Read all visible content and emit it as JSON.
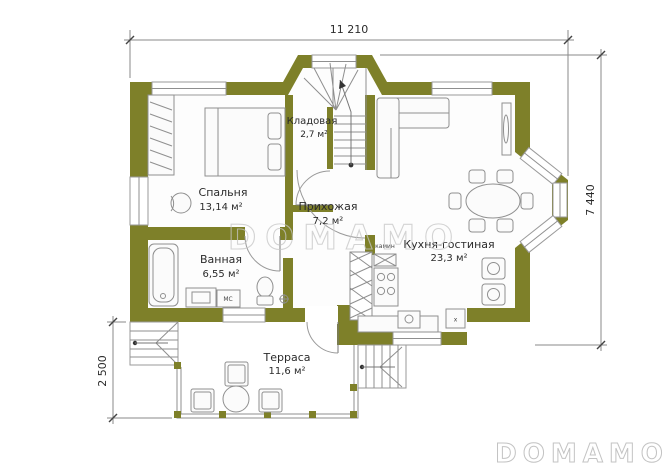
{
  "plan": {
    "watermark": "DOMAMO",
    "dimensions": {
      "width_top": "11 210",
      "height_right": "7 440",
      "porch_left": "2 500"
    },
    "rooms": {
      "bedroom": {
        "name": "Спальня",
        "area": "13,14 м²"
      },
      "storage": {
        "name": "Кладовая",
        "area": "2,7 м²"
      },
      "hallway": {
        "name": "Прихожая",
        "area": "7,2 м²"
      },
      "bathroom": {
        "name": "Ванная",
        "area": "6,55 м²"
      },
      "kitchen": {
        "name": "Кухня-гостиная",
        "area": "23,3 м²"
      },
      "terrace": {
        "name": "Терраса",
        "area": "11,6 м²"
      }
    },
    "labels": {
      "fireplace": "камин",
      "washing_machine": "МС",
      "boiler": "х"
    },
    "colors": {
      "wall": "#7e8029",
      "line": "#8f8f8f",
      "dimension": "#8a8a8a",
      "watermark": "#c6c6c6"
    }
  }
}
